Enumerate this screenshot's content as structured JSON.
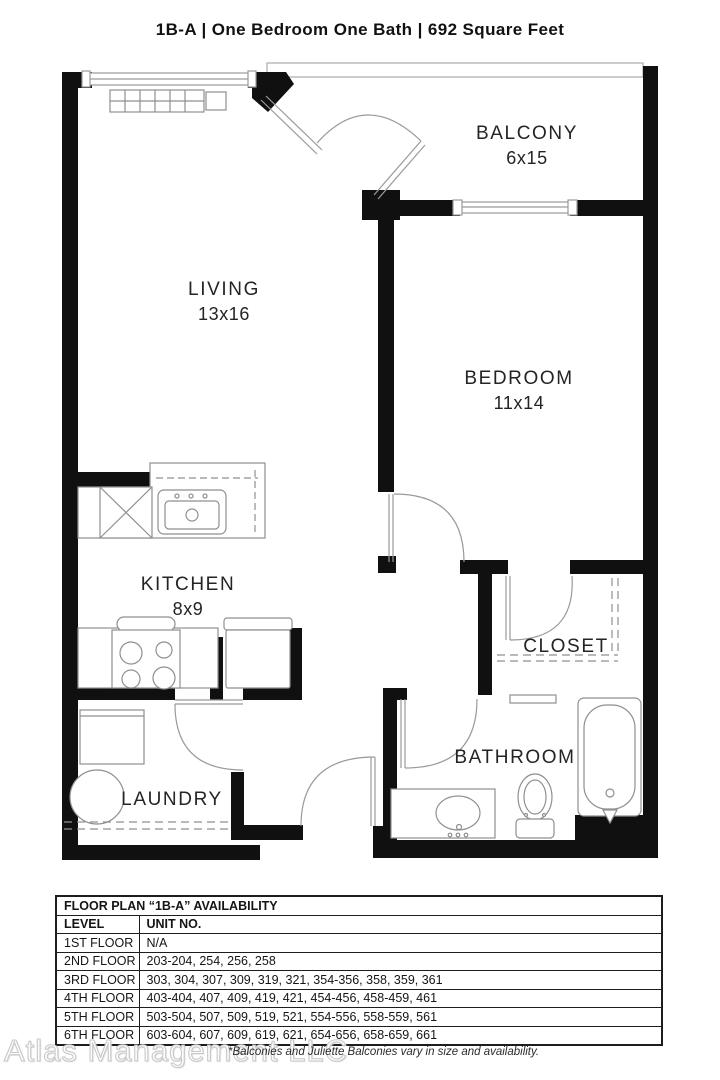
{
  "title": "1B-A | One Bedroom One Bath | 692 Square Feet",
  "floor_plan": {
    "rooms": [
      {
        "name": "BALCONY",
        "dims": "6x15"
      },
      {
        "name": "LIVING",
        "dims": "13x16"
      },
      {
        "name": "BEDROOM",
        "dims": "11x14"
      },
      {
        "name": "KITCHEN",
        "dims": "8x9"
      },
      {
        "name": "CLOSET",
        "dims": ""
      },
      {
        "name": "BATHROOM",
        "dims": ""
      },
      {
        "name": "LAUNDRY",
        "dims": ""
      }
    ]
  },
  "availability_table": {
    "title": "FLOOR PLAN “1B-A” AVAILABILITY",
    "columns": [
      "LEVEL",
      "UNIT NO."
    ],
    "rows": [
      {
        "level": "1ST FLOOR",
        "units": "N/A"
      },
      {
        "level": "2ND FLOOR",
        "units": "203-204, 254, 256, 258"
      },
      {
        "level": "3RD FLOOR",
        "units": "303, 304, 307, 309, 319, 321, 354-356, 358, 359, 361"
      },
      {
        "level": "4TH FLOOR",
        "units": "403-404, 407, 409, 419, 421, 454-456, 458-459, 461"
      },
      {
        "level": "5TH FLOOR",
        "units": "503-504, 507, 509, 519, 521, 554-556, 558-559, 561"
      },
      {
        "level": "6TH FLOOR",
        "units": "603-604, 607, 609, 619, 621, 654-656, 658-659, 661"
      }
    ]
  },
  "footer": {
    "watermark": "Atlas Management LLC",
    "note": "*Balconies and Juliette Balconies vary in size and availability."
  },
  "colors": {
    "wall": "#101010",
    "thin_line": "#9a9a9a",
    "text": "#242424",
    "watermark": "#cfcfcf"
  }
}
